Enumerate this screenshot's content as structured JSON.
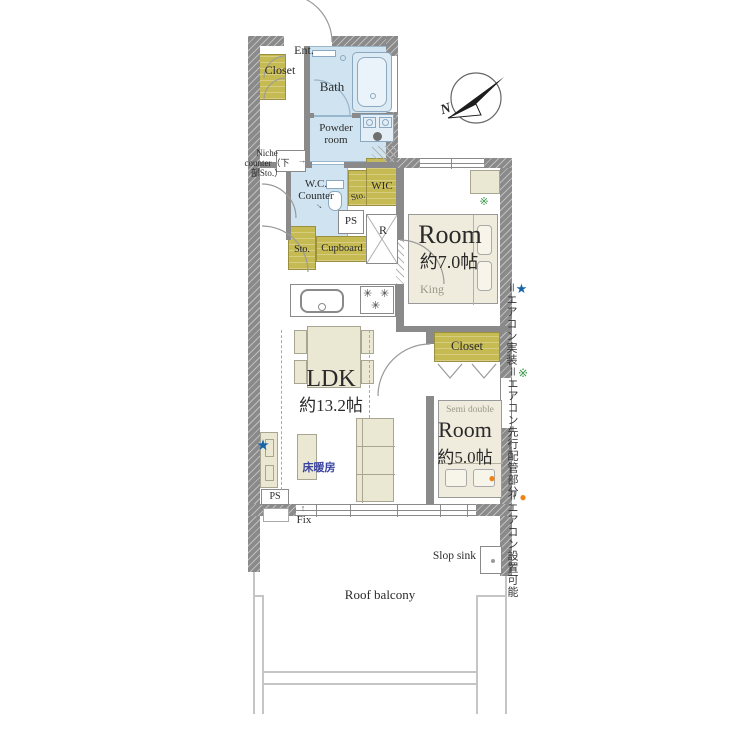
{
  "plan": {
    "ent": "Ent.",
    "entrance_closet": "Closet",
    "bath": "Bath",
    "powder_room": "Powder room",
    "niche_counter": "Niche counter（下部Sto.）",
    "wc_counter": "W.C. Counter",
    "sto_upper": "Sto.",
    "wic": "WIC",
    "ps_upper": "PS",
    "sto_lower": "Sto.",
    "cupboard": "Cupboard",
    "refrigerator": "R",
    "room7_label": "Room",
    "room7_size": "約7.0帖",
    "room7_bed": "King",
    "bedroom_closet": "Closet",
    "room5_label": "Room",
    "room5_size": "約5.0帖",
    "room5_bed": "Semi double",
    "ldk_label": "LDK",
    "ldk_size": "約13.2帖",
    "floor_heating": "床暖房",
    "ps_lower": "PS",
    "fix": "Fix",
    "slop_sink": "Slop sink",
    "roof_balcony": "Roof balcony"
  },
  "compass": {
    "label": "N"
  },
  "legend": {
    "items": [
      {
        "symbol": "★",
        "text": "＝エアコン実装",
        "color": "#1565a8"
      },
      {
        "symbol": "※",
        "text": "＝エアコン先行配管部分",
        "color": "#3a9a4a"
      },
      {
        "symbol": "●",
        "text": "＝エアコン設置可能",
        "color": "#ef8318"
      }
    ]
  },
  "markers": {
    "aircon_installed": "★",
    "aircon_piping": "※",
    "aircon_possible": "●"
  },
  "icons": {
    "arrow_right": "→",
    "arrow_up": "↑",
    "burner": "✳"
  },
  "colors": {
    "wall": "#8a8a8a",
    "water_room": "#cfe3f0",
    "storage": "#c6ba52",
    "furniture": "#eae7d3",
    "accent_star": "#1565a8",
    "accent_piping": "#3a9a4a",
    "accent_possible": "#ef8318",
    "floor_heating_text": "#3a44a0"
  }
}
